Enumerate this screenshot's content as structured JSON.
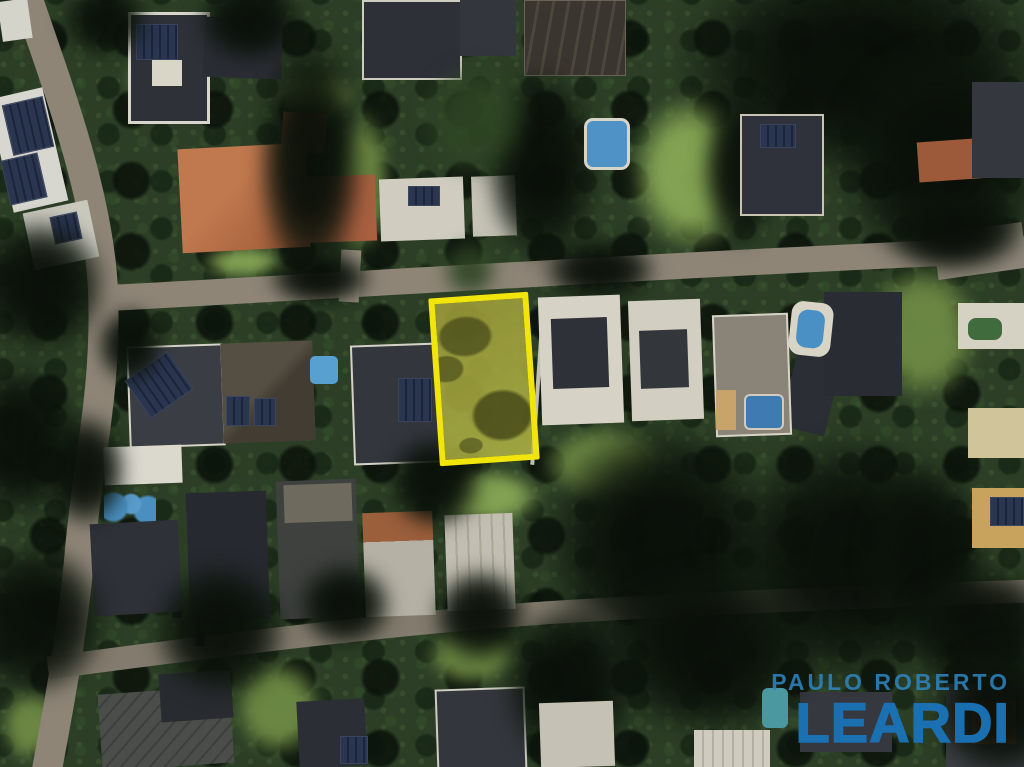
{
  "watermark": {
    "line1": "PAULO ROBERTO",
    "line2": "LEARDI"
  },
  "colors": {
    "brand_blue_primary": "#1a73b7",
    "brand_blue_secondary": "#2e86c3",
    "lot_highlight_yellow": "#f2e50b",
    "lot_highlight_fill": "rgba(183,186,70,0.82)"
  }
}
